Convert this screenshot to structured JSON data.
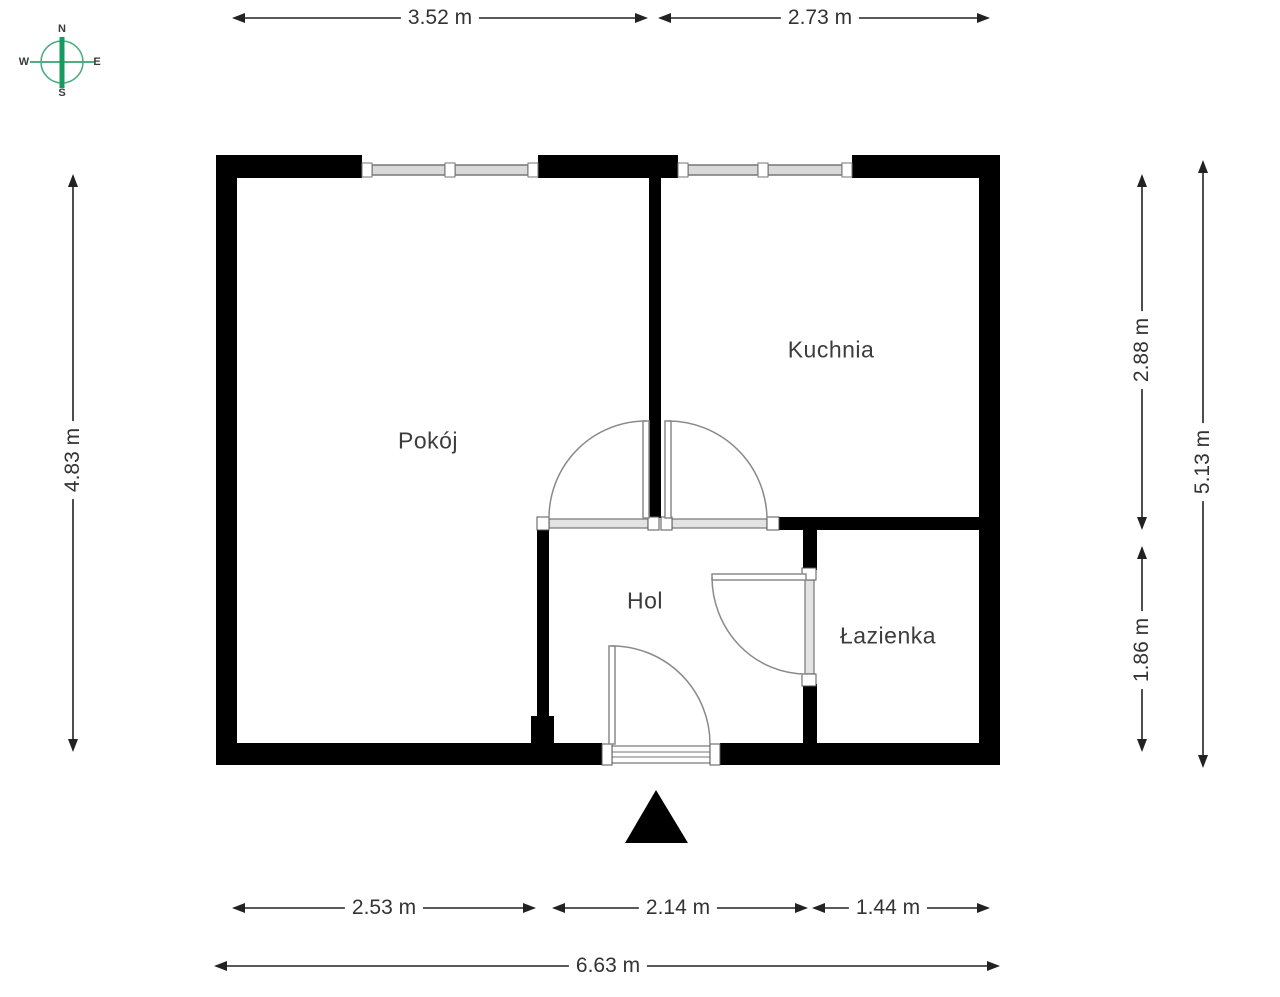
{
  "compass": {
    "labels": {
      "n": "N",
      "s": "S",
      "e": "E",
      "w": "W"
    },
    "ring_color": "#4fae7f",
    "needle_color": "#169a60"
  },
  "rooms": [
    {
      "id": "pokoj",
      "label": "Pokój"
    },
    {
      "id": "kuchnia",
      "label": "Kuchnia"
    },
    {
      "id": "hol",
      "label": "Hol"
    },
    {
      "id": "lazienka",
      "label": "Łazienka"
    }
  ],
  "dimensions": {
    "top": [
      {
        "label": "3.52 m"
      },
      {
        "label": "2.73 m"
      }
    ],
    "left": [
      {
        "label": "4.83 m"
      }
    ],
    "right_inner": [
      {
        "label": "2.88 m"
      },
      {
        "label": "1.86 m"
      }
    ],
    "right_outer": [
      {
        "label": "5.13 m"
      }
    ],
    "bottom_segments": [
      {
        "label": "2.53 m"
      },
      {
        "label": "2.14 m"
      },
      {
        "label": "1.44 m"
      }
    ],
    "bottom_total": [
      {
        "label": "6.63 m"
      }
    ]
  },
  "colors": {
    "wall": "#000000",
    "dimension_line": "#222222",
    "window_fill": "#d9d9d9",
    "window_stroke": "#767676",
    "door_stroke": "#8a8a8a",
    "jamb_fill": "#ffffff"
  }
}
